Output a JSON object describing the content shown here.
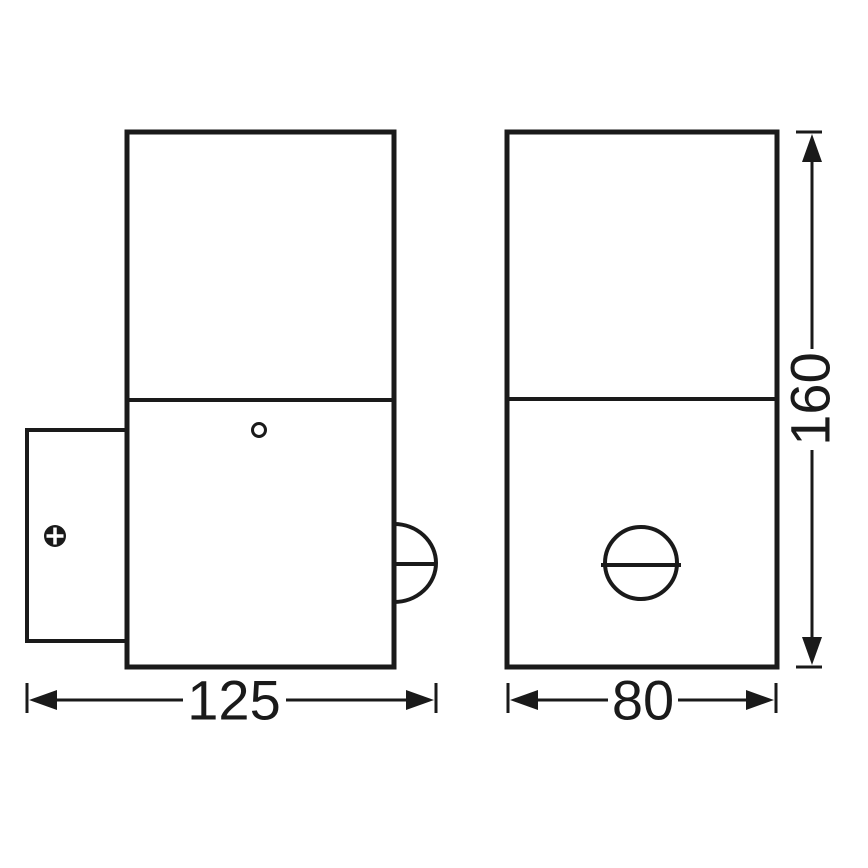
{
  "drawing": {
    "background_color": "#ffffff",
    "line_color": "#1a1a1a",
    "views": {
      "side_view": "side view of wall light with mounting plate, screw and motion sensor bump",
      "front_view": "front view of wall light with round motion sensor"
    },
    "dimensions": {
      "side_width": "125",
      "front_width": "80",
      "height": "160"
    }
  }
}
